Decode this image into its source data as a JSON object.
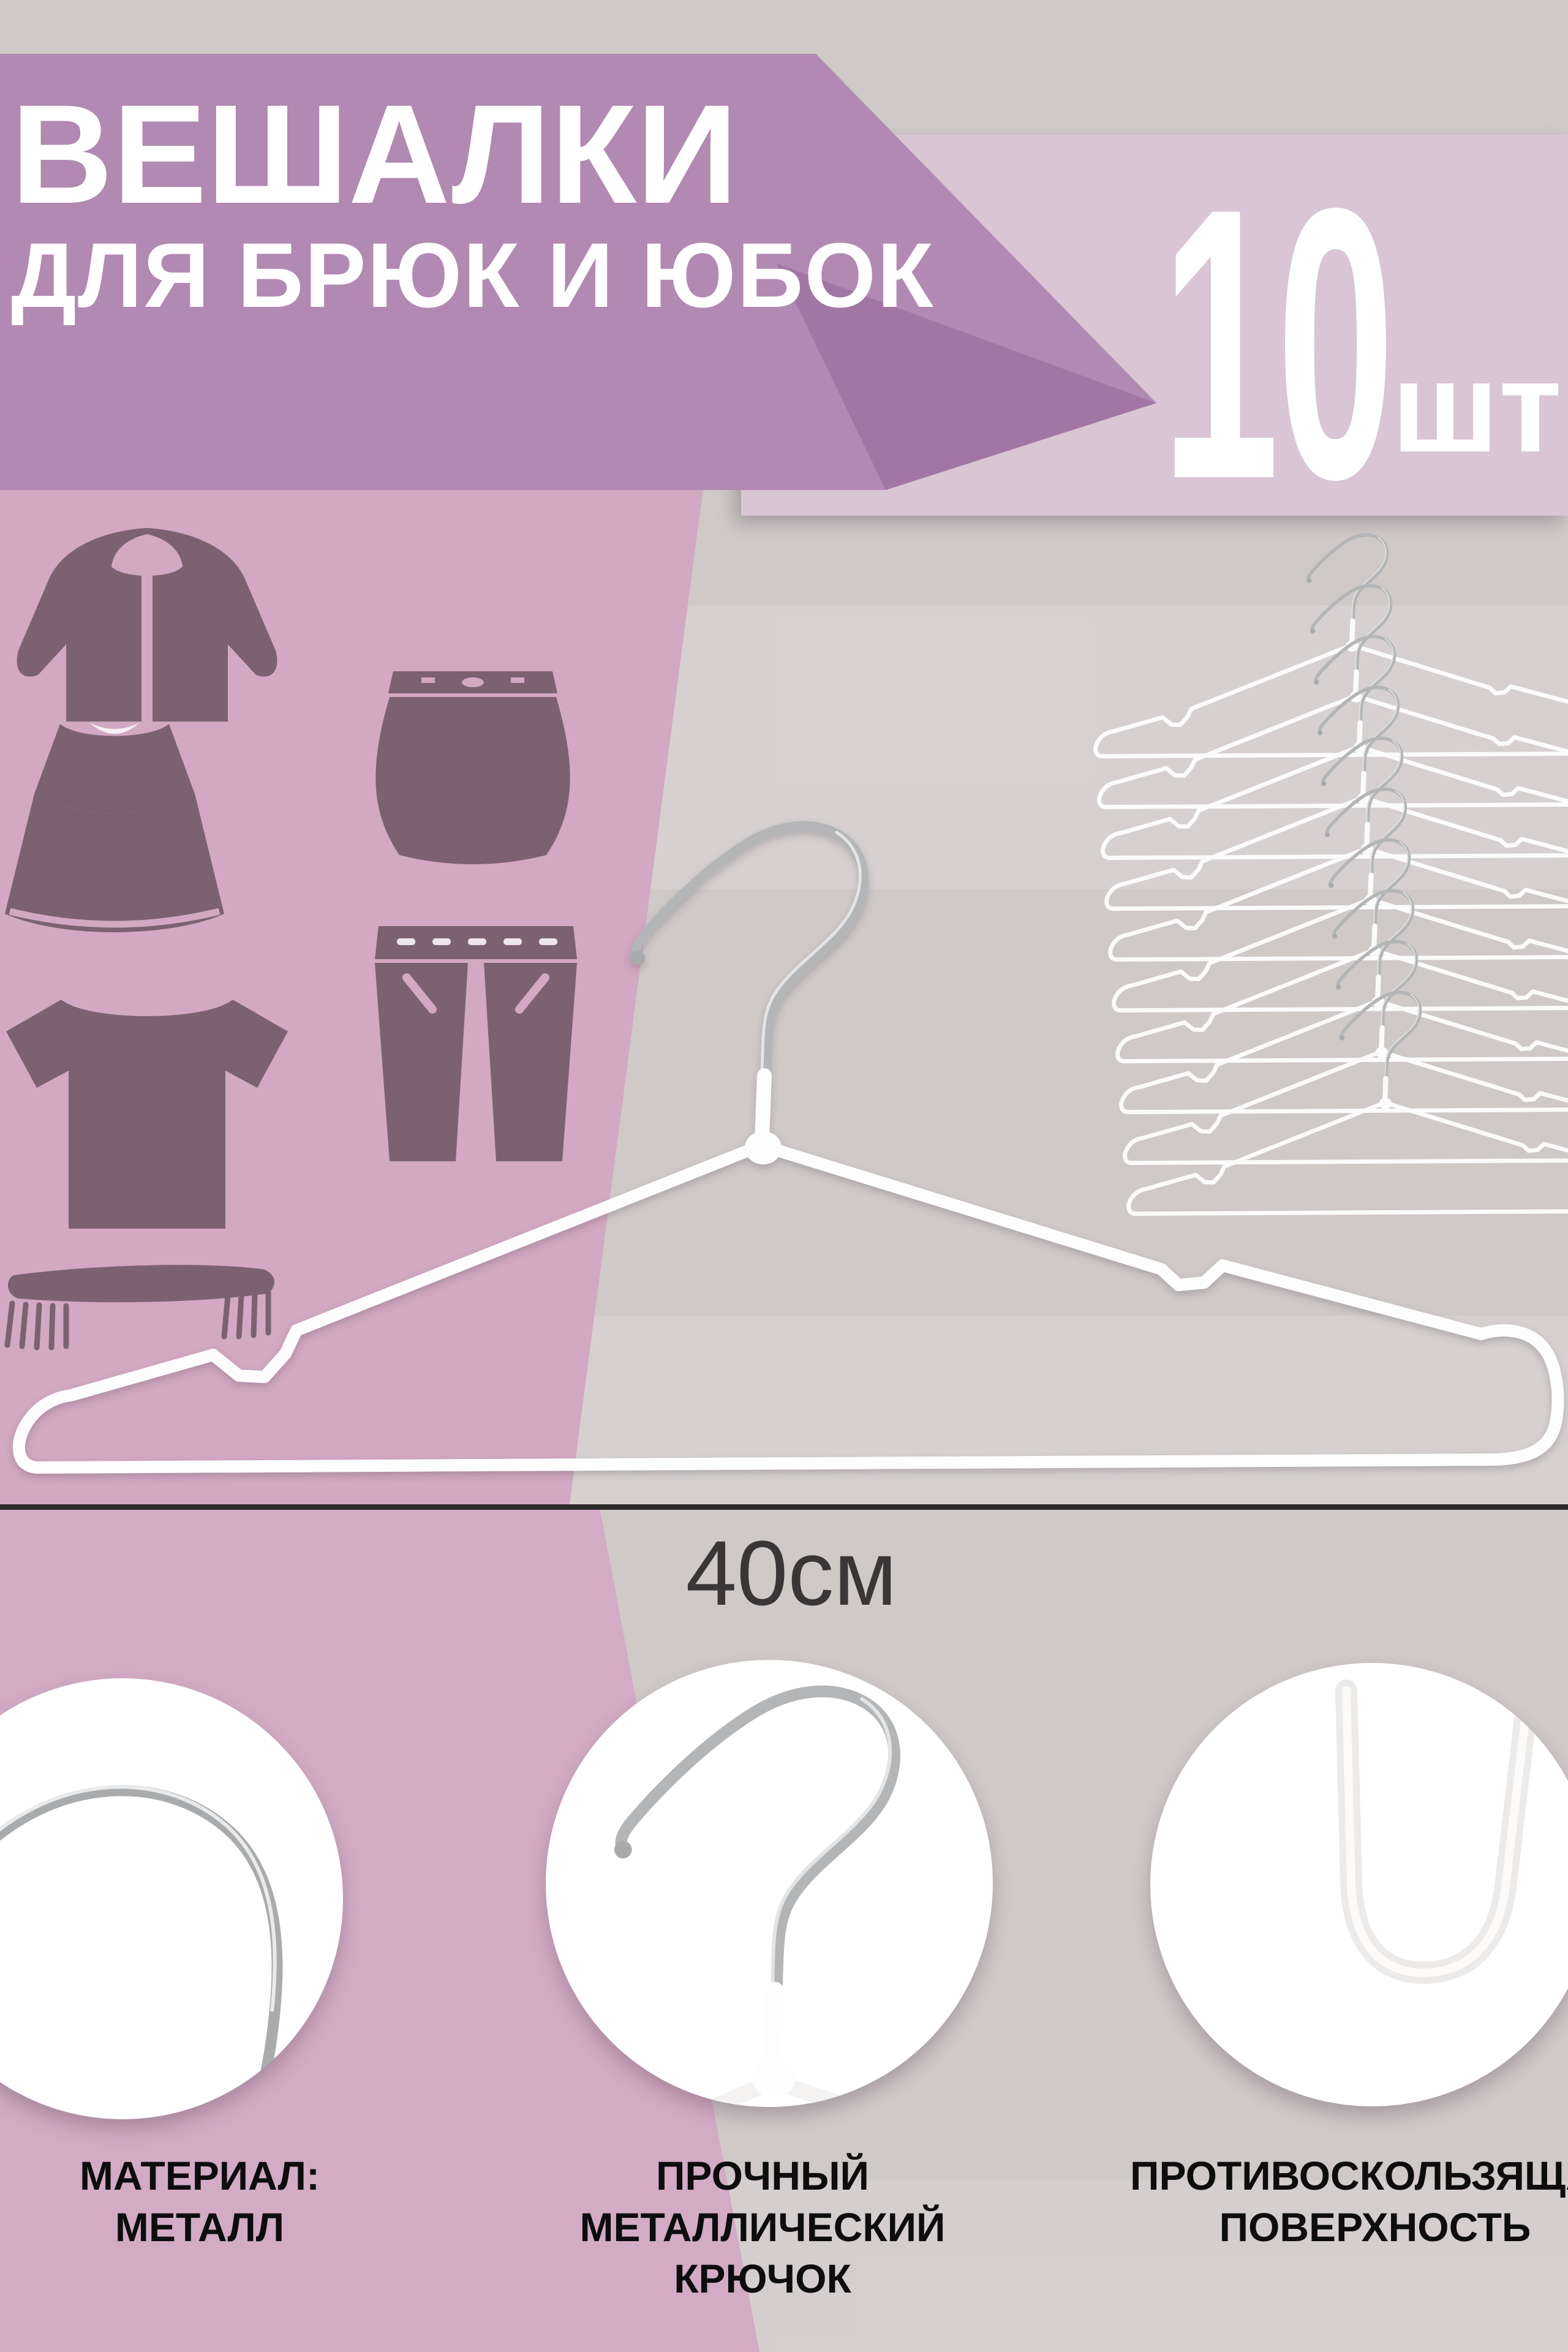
{
  "meta": {
    "kind": "e-commerce product infographic card",
    "language": "Russian"
  },
  "product": {
    "title_line1": "ВЕШАЛКИ",
    "title_line2": "ДЛЯ БРЮК И ЮБОК",
    "quantity": "10",
    "quantity_unit": "шт",
    "size_label": "40см"
  },
  "features": [
    {
      "lines": [
        "МАТЕРИАЛ:",
        "МЕТАЛЛ"
      ]
    },
    {
      "lines": [
        "ПРОЧНЫЙ",
        "МЕТАЛЛИЧЕСКИЙ",
        "КРЮЧОК"
      ]
    },
    {
      "lines": [
        "ПРОТИВОСКОЛЬЗЯЩАЯ",
        "ПОВЕРХНОСТЬ"
      ]
    }
  ],
  "imagery": {
    "main_photo": "white wire trouser hanger with chrome hook, front view",
    "secondary_photo": "stack of 10 white wire hangers, offset vertically",
    "detail_circle_1": "close-up of metal wire arc (material: metal)",
    "detail_circle_2": "close-up of chrome metal hook with white coated joint",
    "detail_circle_3": "close-up of white non-slip coated wire corner",
    "icon_set": [
      "hoodie-icon",
      "skirt-icon",
      "dress-icon",
      "pants-icon",
      "tshirt-icon",
      "scarf-icon"
    ]
  },
  "colors": {
    "background_gray": "#cfc9c8",
    "banner_purple": "#b289b2",
    "banner_fold_purple": "#a276a2",
    "count_block_pink": "#d9c5d3",
    "side_band_pink": "#d2a8c2",
    "bottom_wedge_pink": "#d3abc5",
    "icon_plum": "#7c6270",
    "text_white": "#ffffff",
    "text_black": "#0d0d0d",
    "dimension_dark": "#2d2a2b",
    "chrome_silver": "#b3b5b7",
    "wire_white": "#fdfdfd"
  }
}
